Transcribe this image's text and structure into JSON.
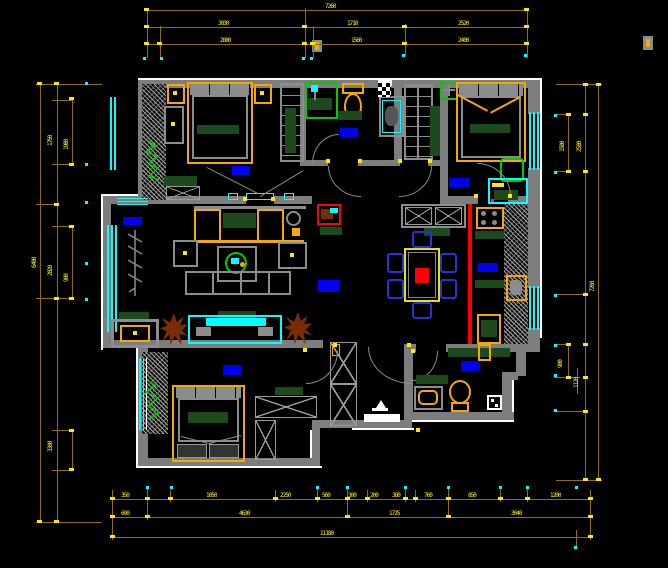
{
  "drawing": {
    "type": "cad-floor-plan",
    "background": "#000000"
  },
  "colors": {
    "wall": "#7d7d7d",
    "outline_white": "#ffffff",
    "dimension_line": "#8f7000",
    "dimension_text": "#ffef00",
    "window_cyan": "#00ffff",
    "label_blue": "#0000f0",
    "furniture_orange": "#f5a800",
    "counter_dark_green": "#1d4a1d",
    "fixture_green": "#00cc00",
    "highlight_red": "#ff0000",
    "plant_brown": "#7a2b08",
    "chair_blue": "#2033dd"
  },
  "icons": {
    "plant-icon": "brown starburst shape",
    "tree-icon": "gray branch polyline",
    "entry-marker-icon": "white triangle with bar",
    "shower-head-icon": "cyan square with stem",
    "fan-icon": "green box with gray cross"
  },
  "dims": {
    "top": {
      "row1": [
        {
          "v": "7260"
        }
      ],
      "row2": [
        {
          "v": "3030"
        },
        {
          "v": "1710"
        },
        {
          "v": "2520"
        }
      ],
      "row3": [
        {
          "v": "2880"
        },
        {
          "v": "1560"
        },
        {
          "v": "2400"
        }
      ]
    },
    "bottom": {
      "row1": [
        {
          "v": "350"
        },
        {
          "v": "1050"
        },
        {
          "v": "2250"
        },
        {
          "v": "560"
        },
        {
          "v": "300"
        },
        {
          "v": "200"
        },
        {
          "v": "380"
        },
        {
          "v": "760"
        },
        {
          "v": "850"
        },
        {
          "v": "1200"
        }
      ],
      "row2": [
        {
          "v": "690"
        },
        {
          "v": "4630"
        },
        {
          "v": "1725"
        },
        {
          "v": "3040"
        }
      ],
      "row3": [
        {
          "v": "11180"
        }
      ]
    },
    "left": [
      {
        "v": "1760"
      },
      {
        "v": "2020"
      },
      {
        "v": "6400"
      },
      {
        "v": "1980"
      },
      {
        "v": "3300"
      },
      {
        "v": "900"
      }
    ],
    "right": [
      {
        "v": "1500"
      },
      {
        "v": "2580"
      },
      {
        "v": "7260"
      },
      {
        "v": "900"
      },
      {
        "v": "1120"
      }
    ]
  }
}
